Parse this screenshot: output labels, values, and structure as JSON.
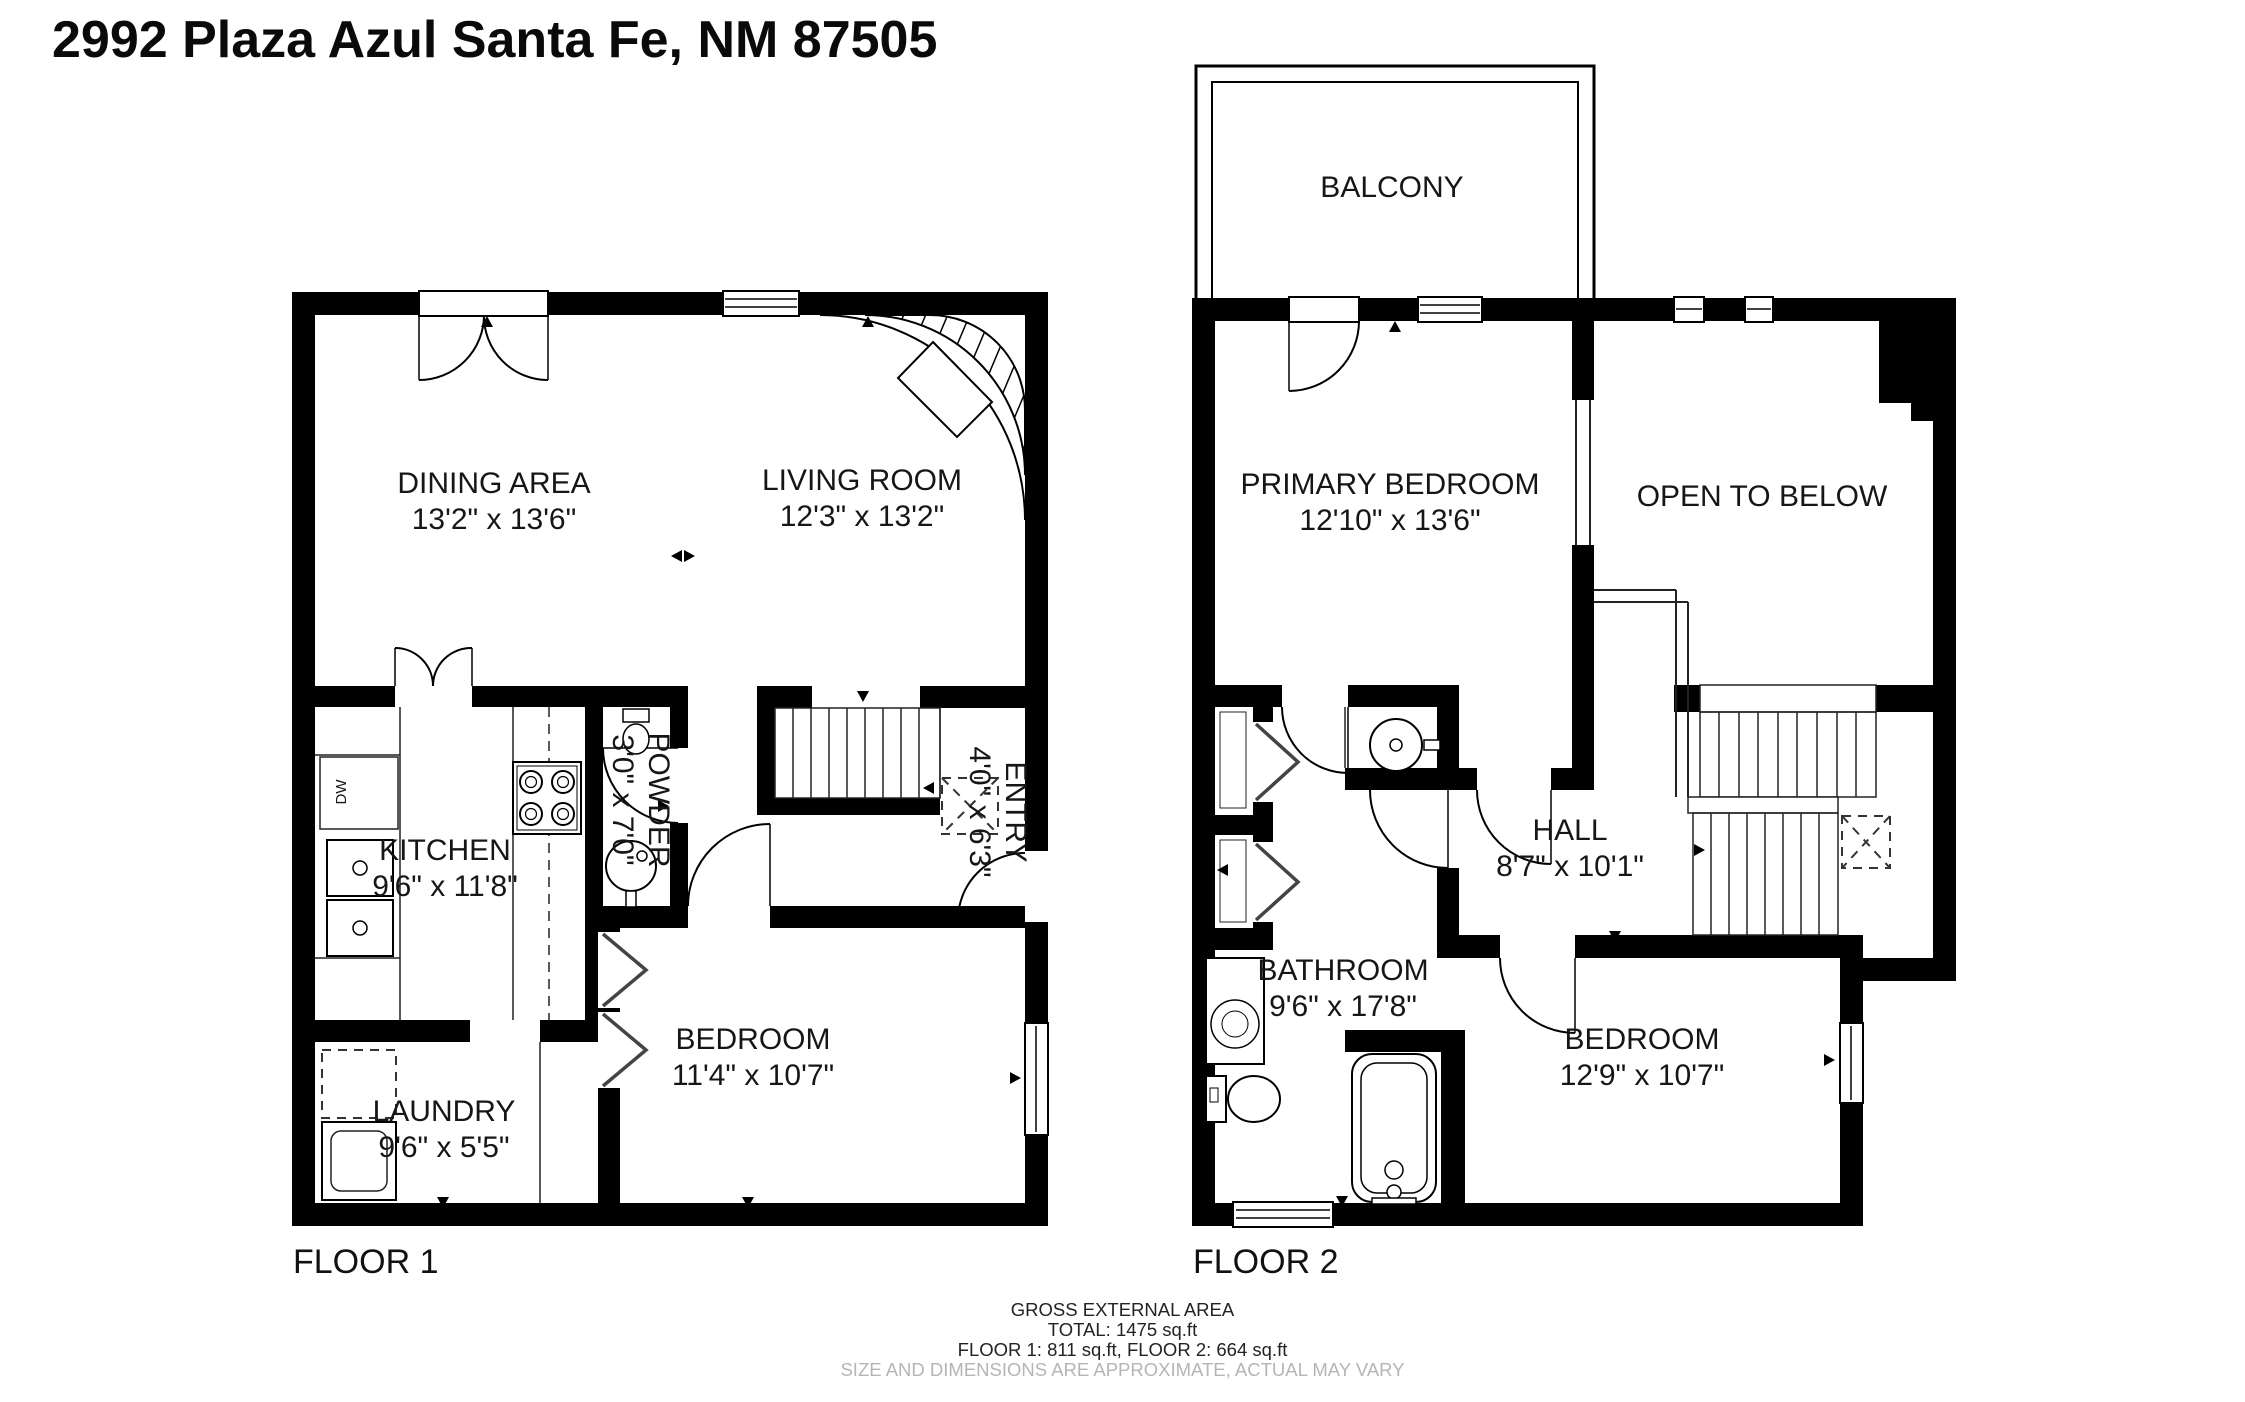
{
  "title": "2992 Plaza Azul Santa Fe, NM 87505",
  "floor1": {
    "label": "FLOOR 1",
    "rooms": {
      "dining": {
        "name": "DINING AREA",
        "dims": "13'2\" x 13'6\""
      },
      "living": {
        "name": "LIVING ROOM",
        "dims": "12'3\" x 13'2\""
      },
      "kitchen": {
        "name": "KITCHEN",
        "dims": "9'6\" x 11'8\""
      },
      "powder": {
        "name": "POWDER",
        "dims": "3'0\" x 7'0\""
      },
      "entry": {
        "name": "ENTRY",
        "dims": "4'0\" x 6'3\""
      },
      "bedroom": {
        "name": "BEDROOM",
        "dims": "11'4\" x 10'7\""
      },
      "laundry": {
        "name": "LAUNDRY",
        "dims": "9'6\" x 5'5\""
      }
    },
    "appliances": {
      "dishwasher": "DW"
    }
  },
  "floor2": {
    "label": "FLOOR 2",
    "rooms": {
      "balcony": {
        "name": "BALCONY"
      },
      "primary": {
        "name": "PRIMARY BEDROOM",
        "dims": "12'10\" x 13'6\""
      },
      "open_below": {
        "name": "OPEN TO BELOW"
      },
      "hall": {
        "name": "HALL",
        "dims": "8'7\" x 10'1\""
      },
      "bathroom": {
        "name": "BATHROOM",
        "dims": "9'6\" x 17'8\""
      },
      "bedroom": {
        "name": "BEDROOM",
        "dims": "12'9\" x 10'7\""
      }
    }
  },
  "footer": {
    "line1": "GROSS EXTERNAL AREA",
    "line2": "TOTAL: 1475 sq.ft",
    "line3": "FLOOR 1: 811 sq.ft, FLOOR 2: 664 sq.ft",
    "line4": "SIZE AND DIMENSIONS ARE APPROXIMATE, ACTUAL MAY VARY"
  },
  "colors": {
    "wall": "#000000",
    "line": "#222222",
    "muted_text": "#b5b5b5",
    "background": "#ffffff"
  }
}
